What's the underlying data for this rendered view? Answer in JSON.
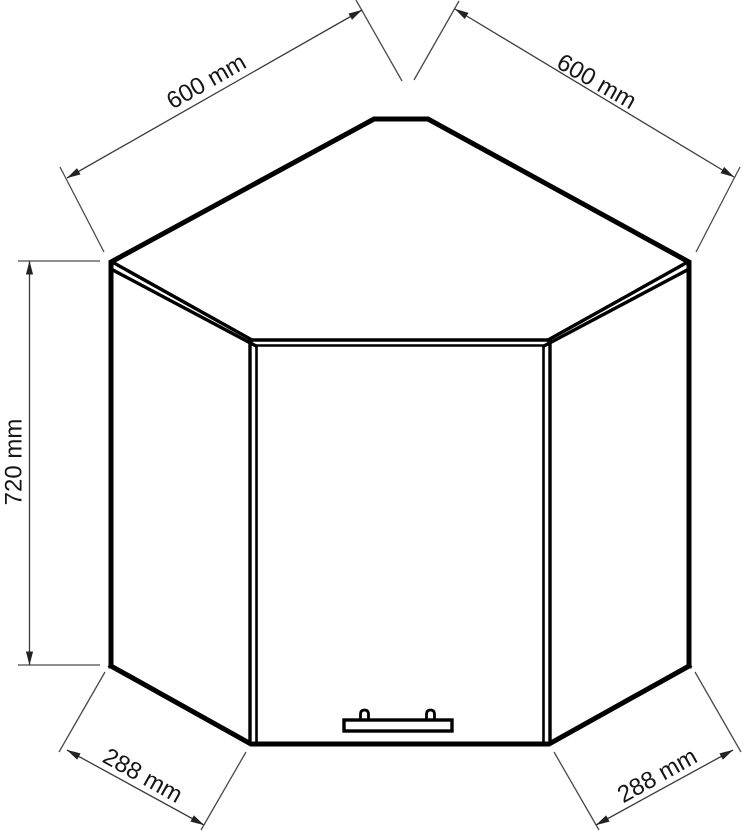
{
  "page": {
    "background_color": "#ffffff"
  },
  "drawing": {
    "kind": "corner-wall-cabinet-technical-drawing",
    "line_color": "#000000",
    "dimension_line_color": "#3a3a3a",
    "label_color": "#161616",
    "dimensions": {
      "top_left_width": {
        "label": "600 mm",
        "value": 600,
        "unit": "mm"
      },
      "top_right_width": {
        "label": "600 mm",
        "value": 600,
        "unit": "mm"
      },
      "height": {
        "label": "720 mm",
        "value": 720,
        "unit": "mm"
      },
      "bottom_left_front": {
        "label": "288 mm",
        "value": 288,
        "unit": "mm"
      },
      "bottom_right_front": {
        "label": "288 mm",
        "value": 288,
        "unit": "mm"
      }
    }
  }
}
